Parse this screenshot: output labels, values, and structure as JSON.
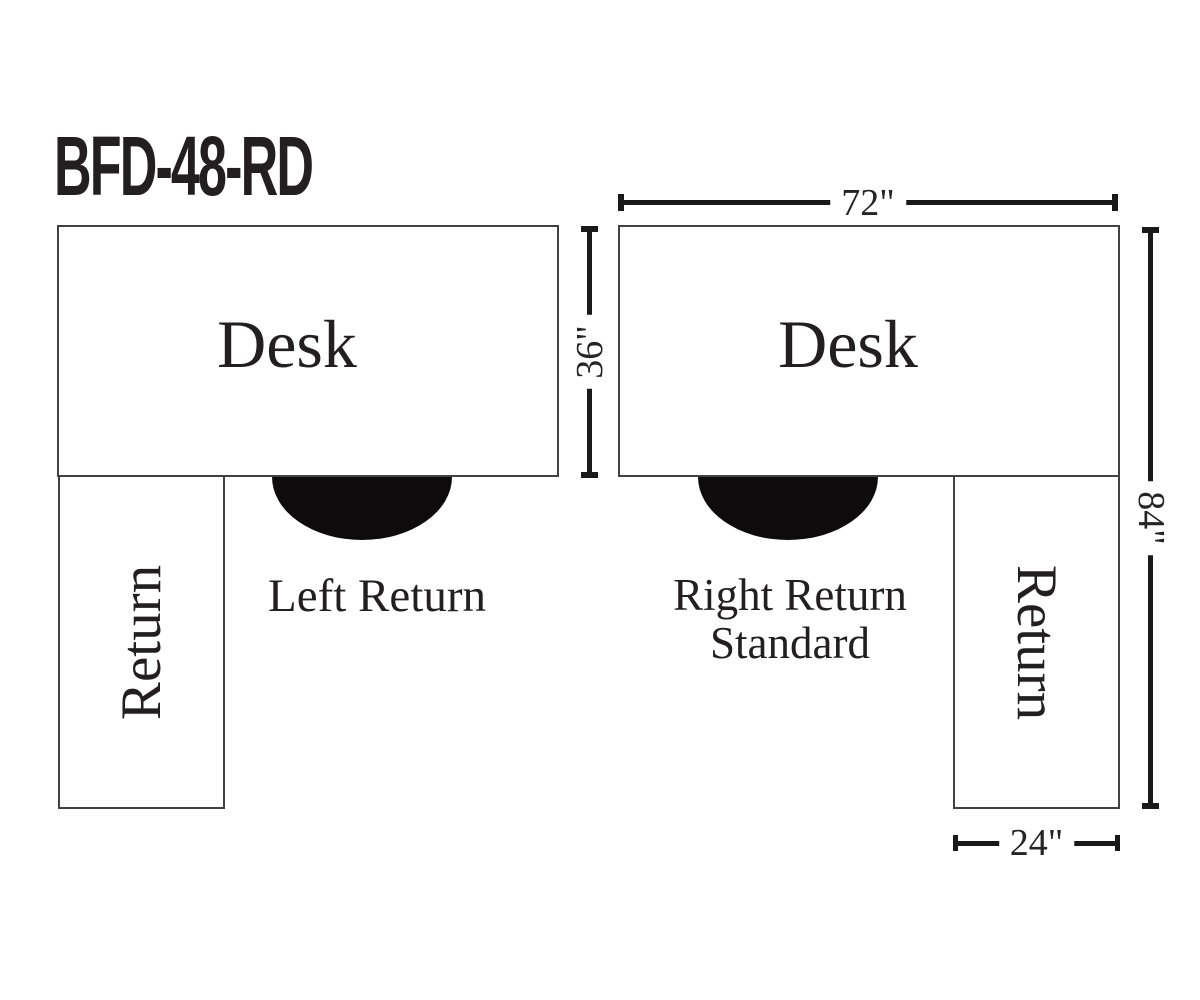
{
  "title": "BFD-48-RD",
  "left_diagram": {
    "desk_label": "Desk",
    "return_label": "Return",
    "caption": "Left Return"
  },
  "right_diagram": {
    "desk_label": "Desk",
    "return_label": "Return",
    "caption_line1": "Right Return",
    "caption_line2": "Standard"
  },
  "dimensions": {
    "desk_width": "72\"",
    "desk_depth": "36\"",
    "total_depth": "84\"",
    "return_width": "24\""
  },
  "icons": {
    "chair": "chair-half-circle"
  },
  "colors": {
    "ink": "#231f20",
    "shape_border": "#424242",
    "dimension_line": "#191919",
    "chair_fill": "#0d0b0c",
    "background": "#ffffff"
  }
}
